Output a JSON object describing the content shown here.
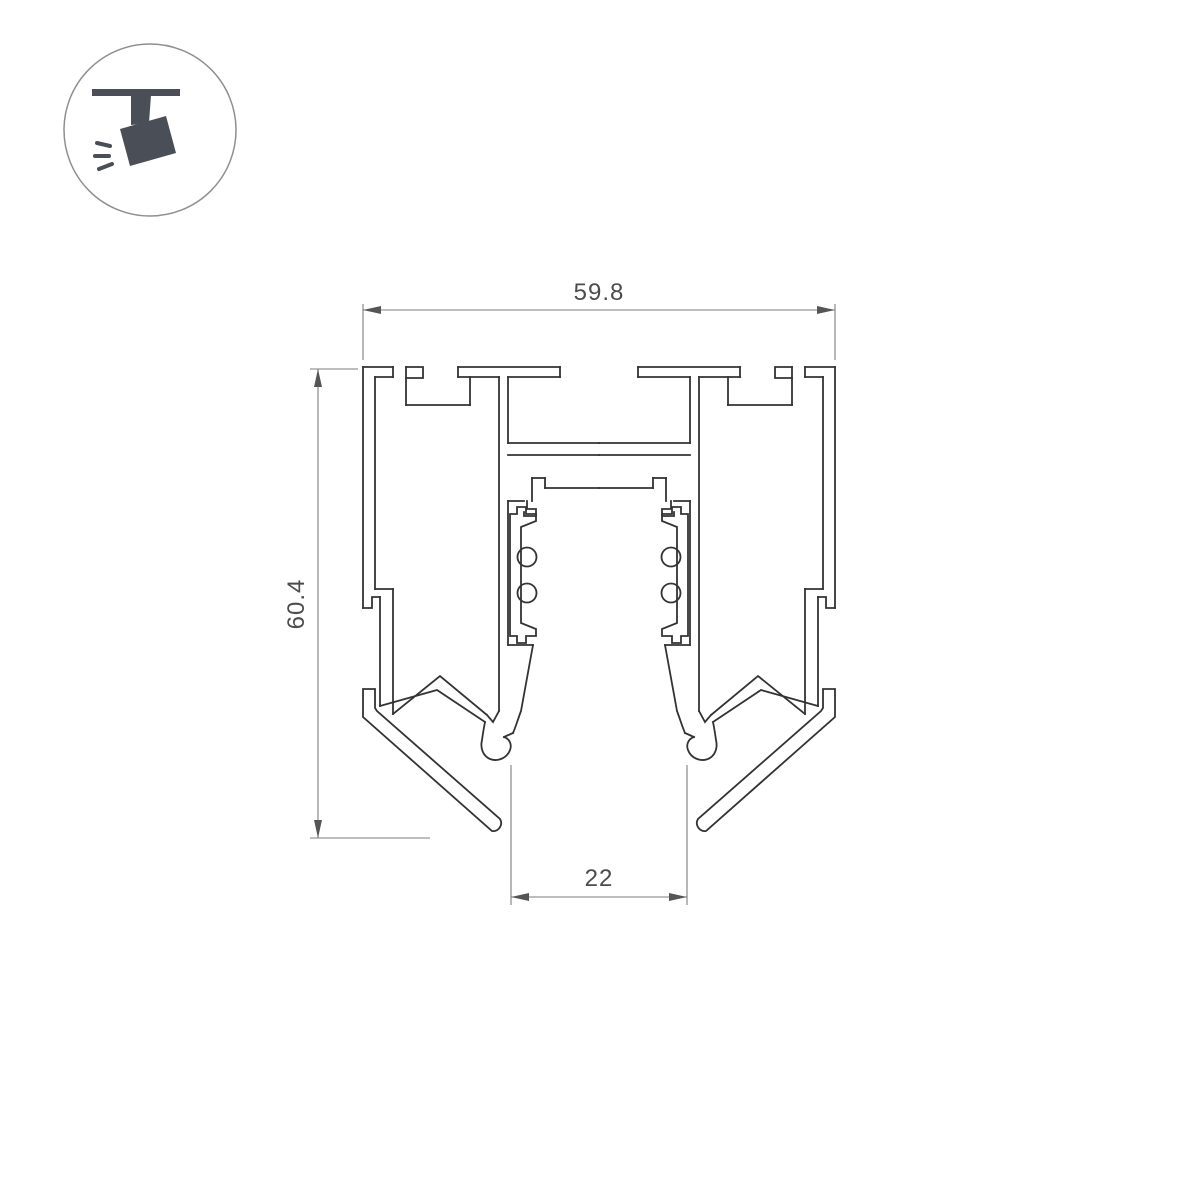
{
  "page": {
    "background_color": "#ffffff",
    "drawing_line_color": "#333333",
    "dimension_line_color": "#7d7d7d",
    "dimension_text_color": "#4c4c4c",
    "logo_icon_color": "#4a4f57",
    "logo_circle_color": "#8f8f8f"
  },
  "logo": {
    "name": "track-spotlight-badge",
    "icon": "track-light-icon"
  },
  "drawing": {
    "type": "technical-cross-section",
    "subject": "magnetic-track-profile",
    "dimensions": {
      "width": {
        "value": "59.8"
      },
      "height": {
        "value": "60.4"
      },
      "slot_width": {
        "value": "22"
      }
    }
  }
}
